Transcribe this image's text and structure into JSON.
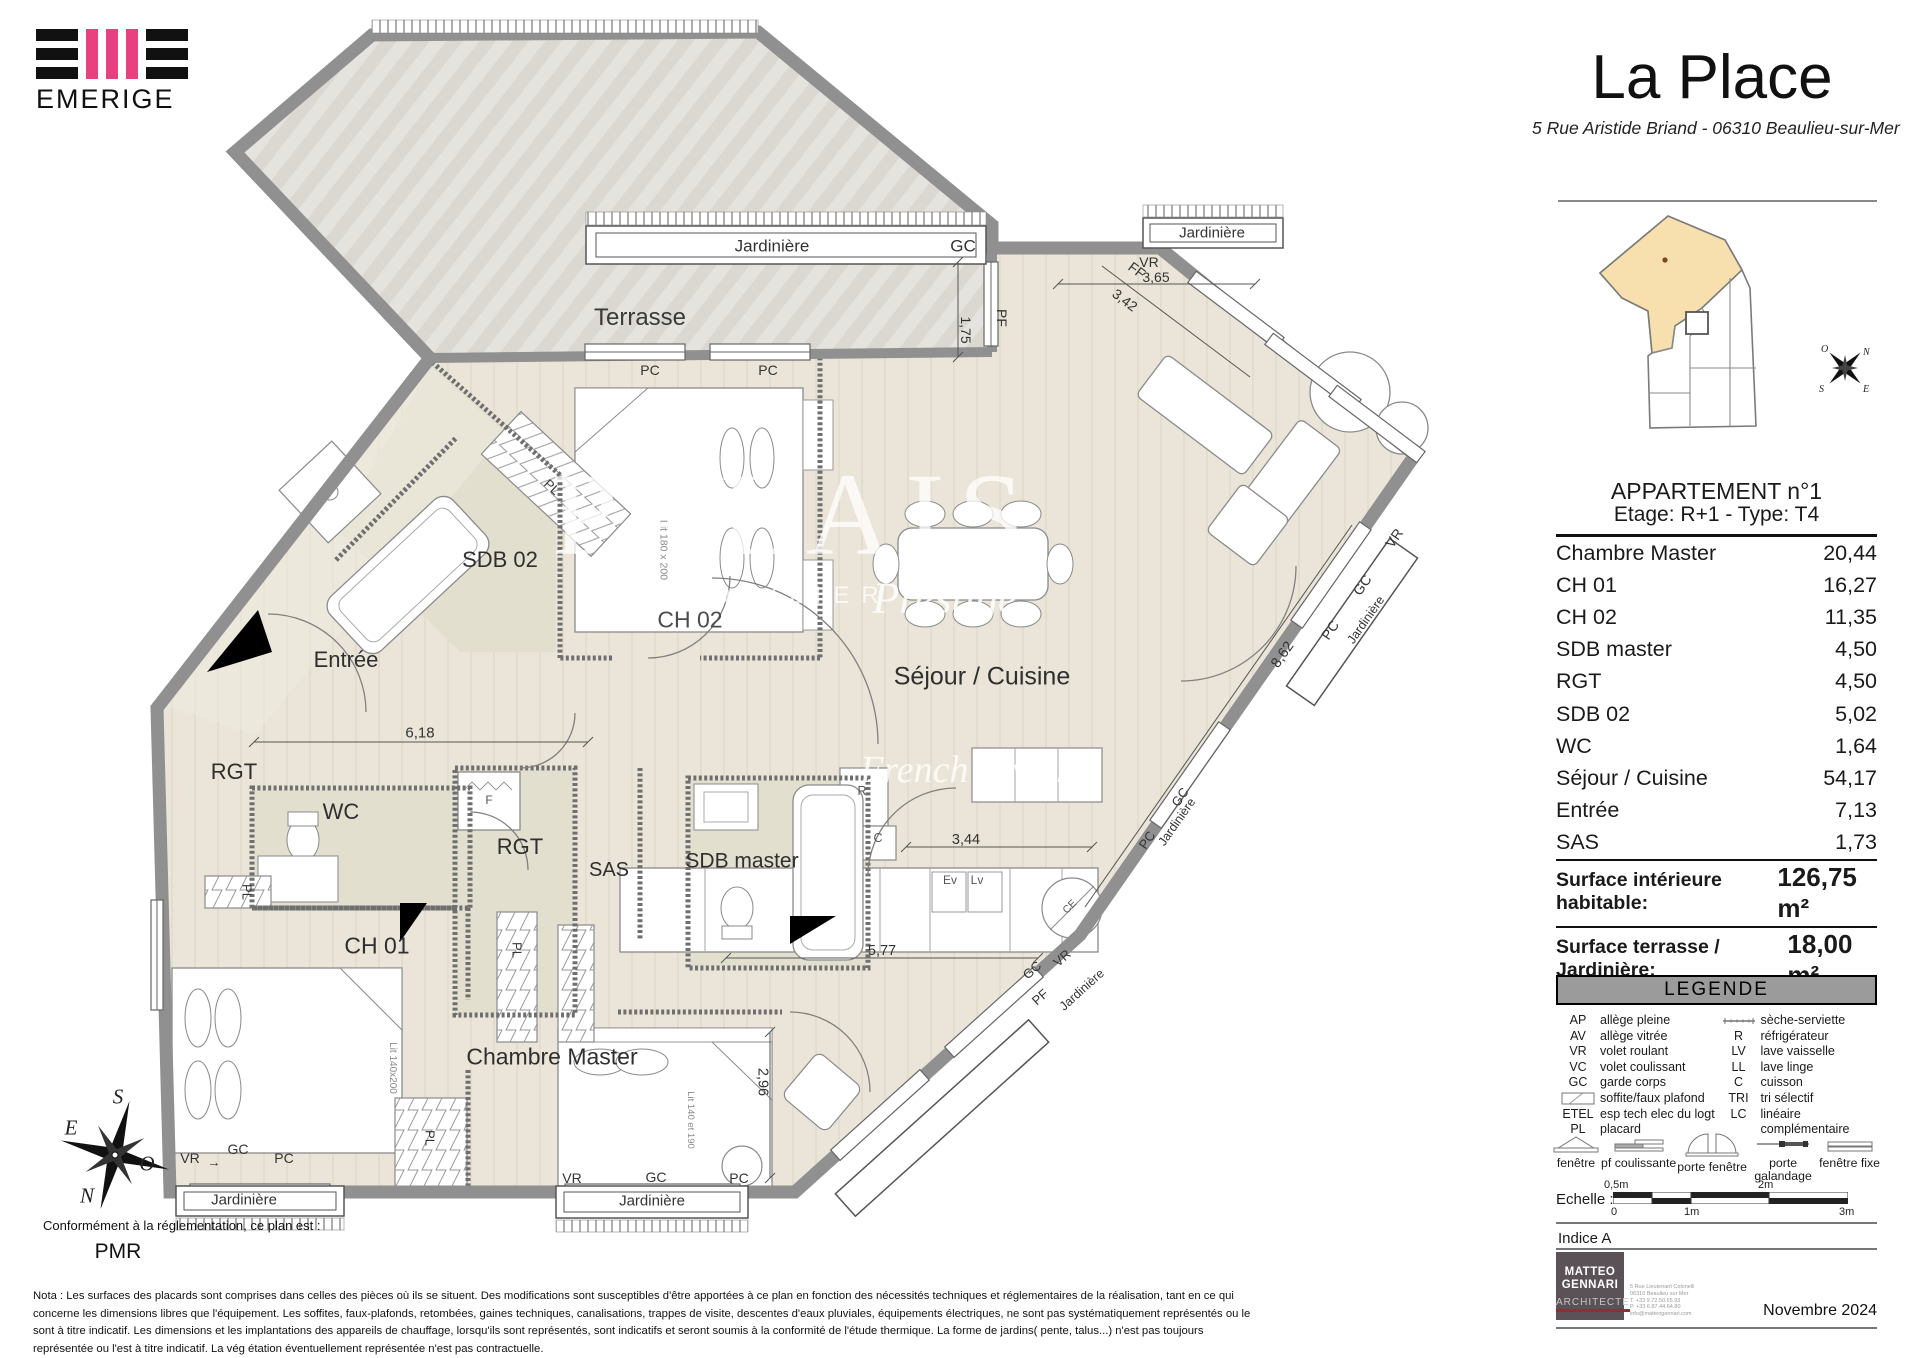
{
  "logo": {
    "brand": "EMERIGE"
  },
  "header": {
    "title": "La Place",
    "address": "5 Rue Aristide Briand - 06310 Beaulieu-sur-Mer"
  },
  "minimap": {
    "unit_title": "APPARTEMENT n°1",
    "unit_subtitle": "Etage: R+1 - Type: T4",
    "compass": {
      "o": "O",
      "n": "N",
      "s": "S",
      "e": "E"
    },
    "highlight_color": "#f8dfae"
  },
  "areas": {
    "rows": [
      {
        "label": "Chambre Master",
        "value": "20,44"
      },
      {
        "label": "CH 01",
        "value": "16,27"
      },
      {
        "label": "CH 02",
        "value": "11,35"
      },
      {
        "label": "SDB master",
        "value": "4,50"
      },
      {
        "label": "RGT",
        "value": "4,50"
      },
      {
        "label": "SDB 02",
        "value": "5,02"
      },
      {
        "label": "WC",
        "value": "1,64"
      },
      {
        "label": "Séjour / Cuisine",
        "value": "54,17"
      },
      {
        "label": "Entrée",
        "value": "7,13"
      },
      {
        "label": "SAS",
        "value": "1,73"
      }
    ],
    "surface_interior": {
      "label": "Surface intérieure habitable:",
      "value": "126,75 m²"
    },
    "surface_terrace": {
      "label": "Surface terrasse / Jardinière:",
      "value": "18,00 m²"
    }
  },
  "legend": {
    "title": "LEGENDE",
    "left": [
      [
        "AP",
        "allège pleine"
      ],
      [
        "AV",
        "allège vitrée"
      ],
      [
        "VR",
        "volet roulant"
      ],
      [
        "VC",
        "volet coulissant"
      ],
      [
        "GC",
        "garde corps"
      ],
      [
        "",
        "soffite/faux plafond"
      ],
      [
        "ETEL",
        "esp tech elec  du logt"
      ],
      [
        "PL",
        "placard"
      ]
    ],
    "right": [
      [
        "",
        "sèche-serviette"
      ],
      [
        "R",
        "réfrigérateur"
      ],
      [
        "LV",
        "lave vaisselle"
      ],
      [
        "LL",
        "lave linge"
      ],
      [
        "C",
        "cuisson"
      ],
      [
        "TRI",
        "tri sélectif"
      ],
      [
        "LC",
        "linéaire complémentaire"
      ]
    ],
    "symbols": [
      "fenêtre",
      "pf coulissante",
      "porte fenêtre",
      "porte galandage",
      "fenêtre fixe"
    ]
  },
  "scale": {
    "label": "Echelle :",
    "t0": "0",
    "t05": "0,5m",
    "t1": "1m",
    "t2": "2m",
    "t3": "3m"
  },
  "indice": "Indice A",
  "architect": {
    "l1": "MATTEO",
    "l2": "GENNARI",
    "l3": "ARCHITECTE",
    "contact": [
      "5 Rue Lieutenant Colonelli",
      "06310 Beaulieu sur Mer",
      "T. +33  9.72.50.65.93",
      "P. +33  6.87.44.64.80",
      "info@matteogennari.com"
    ],
    "date": "Novembre 2024"
  },
  "plan": {
    "rooms": {
      "terrasse": "Terrasse",
      "entree": "Entrée",
      "rgt": "RGT",
      "wc": "WC",
      "sas": "SAS",
      "sdb_master": "SDB master",
      "sdb02": "SDB 02",
      "ch01": "CH 01",
      "ch02": "CH 02",
      "chambre_master": "Chambre Master",
      "sejour": "Séjour / Cuisine"
    },
    "edge": {
      "jardiniere": "Jardinière",
      "gc": "GC",
      "vr": "VR",
      "pc": "PC",
      "pf": "PF",
      "ff": "FF",
      "pl": "PL",
      "arrow": "→"
    },
    "dims": {
      "d175": "1,75",
      "d365": "3,65",
      "d342": "3,42",
      "d862": "8,62",
      "d618": "6,18",
      "d344": "3,44",
      "d577": "5,77",
      "d296": "2,96"
    },
    "furniture": {
      "lit180": "Lit 180 x 200",
      "lit140a": "Lit 140x200",
      "lit140b": "Lit 140 et 190",
      "f": "F",
      "r": "R",
      "c": "C",
      "ev": "Ev",
      "lv": "Lv",
      "ce": "CE"
    },
    "compass": {
      "s": "S",
      "e": "E",
      "o": "O",
      "n": "N"
    },
    "pmr": {
      "intro": "Conformément à la réglementation, ce plan est :",
      "label": "PMR"
    },
    "watermark": {
      "main": "PALAIS",
      "sub": "IMMOBILIER",
      "script": "Prestige",
      "script2": "French Riviera"
    }
  },
  "nota": "Nota : Les surfaces des placards sont comprises dans celles des pièces où ils se situent. Des modifications sont susceptibles d'être apportées à ce plan en fonction des nécessités techniques et réglementaires de la réalisation, tant en ce qui concerne les dimensions libres que l'équipement.  Les soffites, faux-plafonds, retombées, gaines techniques, canalisations, trappes de visite, descentes d'eaux pluviales, équipements électriques, ne sont pas systématiquement représentés ou le sont à titre indicatif. Les dimensions et les implantations des appareils de chauffage, lorsqu'ils sont représentés, sont indicatifs et seront soumis à la conformité de l'étude thermique.  La forme de jardins( pente, talus...) n'est pas toujours représentée ou l'est à titre indicatif. La vég étation éventuellement représentée n'est pas contractuelle."
}
